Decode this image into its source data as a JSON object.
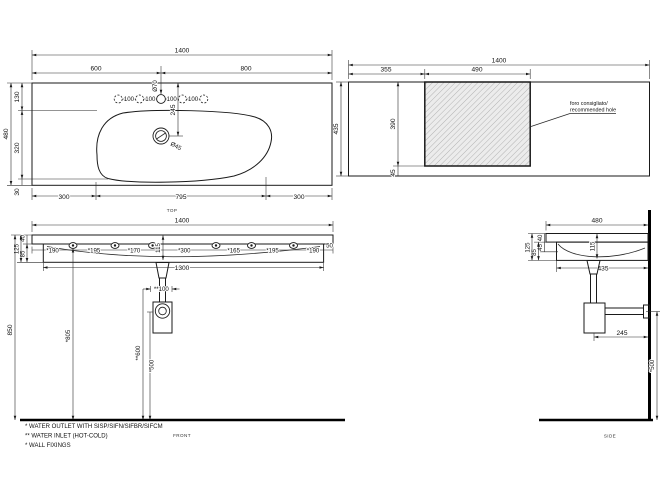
{
  "drawing_title": "wall-hung washbasin 1400 technical drawing",
  "colors": {
    "line": "#1a1a1a",
    "background": "#ffffff",
    "hatch_fill": "#ececec",
    "hatch_line": "#9a9a9a"
  },
  "views": {
    "top": {
      "label": "TOP",
      "overall_width": "1400",
      "left_span": "600",
      "right_span": "800",
      "hole_pitch": "100",
      "tap_hole_dia": "Ø70",
      "drain_offset": "245",
      "drain_dia": "Ø45",
      "edge_to_basin": "130",
      "overall_depth": "480",
      "basin_span": "320",
      "bottom_margin": "30",
      "bottom_left": "300",
      "bottom_center": "795",
      "bottom_right": "300"
    },
    "cutout": {
      "overall_width": "1400",
      "offset_left": "355",
      "hole_width": "490",
      "overall_depth": "435",
      "hole_depth": "390",
      "bottom_margin": "45",
      "note_line1": "foro consigliato/",
      "note_line2": "recommended hole"
    },
    "front": {
      "label": "FRONT",
      "overall_width": "1400",
      "body_width": "1300",
      "overall_height": "850",
      "fix_1": "*190",
      "fix_2": "*195",
      "fix_3": "*170",
      "fix_4": "*300",
      "fix_5": "*165",
      "fix_6": "*195",
      "fix_7": "*190",
      "edge_dim": "50",
      "basin_inner_depth": "115",
      "slab_thickness": "40",
      "apron_height": "85",
      "front_height": "125",
      "inlet_spacing": "**100",
      "fixing_height": "*805",
      "inlet_height": "**600",
      "outlet_height": "*500"
    },
    "side": {
      "label": "SIDE",
      "overall_depth": "480",
      "slab_thickness": "40",
      "front_height": "125",
      "apron_height": "85",
      "lip_height": "45",
      "basin_inner_depth": "115",
      "bottom_span": "435",
      "outlet_wall_offset": "245",
      "outlet_height": "*500"
    },
    "legend": {
      "line1": "*  WATER OUTLET WITH SISP/SIFN/SIFBR/SIFCM",
      "line2": "** WATER INLET  (HOT-COLD)",
      "line3": "* WALL FIXINGS"
    }
  }
}
